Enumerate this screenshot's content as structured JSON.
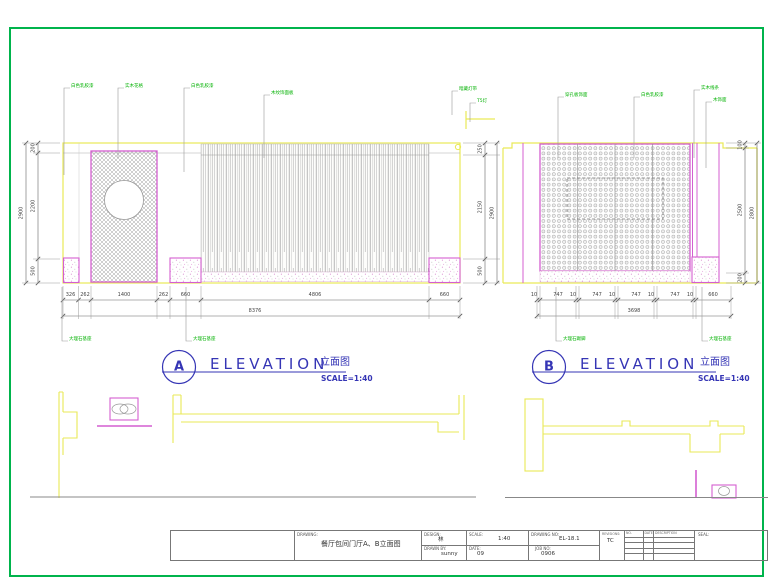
{
  "page": {
    "border_color": "#00b44c"
  },
  "titles": {
    "a": {
      "letter": "A",
      "word": "ELEVATION",
      "cn": "立面图",
      "scale": "SCALE=1:40"
    },
    "b": {
      "letter": "B",
      "word": "ELEVATION",
      "cn": "立面图",
      "scale": "SCALE=1:40"
    }
  },
  "dim_lines": [
    {
      "o": "h",
      "y": 300,
      "x1": 63,
      "x2": 460,
      "ticks": [
        63,
        78.5,
        91,
        157,
        170,
        201,
        429,
        460
      ],
      "labels": [
        {
          "t": "326",
          "x": 70.5
        },
        {
          "t": "262",
          "x": 85
        },
        {
          "t": "1400",
          "x": 124
        },
        {
          "t": "262",
          "x": 163.5
        },
        {
          "t": "660",
          "x": 185.5
        },
        {
          "t": "4806",
          "x": 315
        },
        {
          "t": "660",
          "x": 444.5
        }
      ]
    },
    {
      "o": "h",
      "y": 316,
      "x1": 63,
      "x2": 460,
      "ticks": [
        63,
        460
      ],
      "labels": [
        {
          "t": "8376",
          "x": 255
        }
      ]
    },
    {
      "o": "h",
      "y": 300,
      "x1": 537,
      "x2": 731,
      "ticks": [
        537,
        540,
        576,
        579,
        615,
        618,
        654,
        657,
        693,
        696,
        731
      ],
      "labels": [
        {
          "t": "10",
          "x": 534
        },
        {
          "t": "747",
          "x": 558
        },
        {
          "t": "10",
          "x": 573
        },
        {
          "t": "747",
          "x": 597
        },
        {
          "t": "10",
          "x": 612
        },
        {
          "t": "747",
          "x": 636
        },
        {
          "t": "10",
          "x": 651
        },
        {
          "t": "747",
          "x": 675
        },
        {
          "t": "10",
          "x": 690
        },
        {
          "t": "660",
          "x": 713
        }
      ]
    },
    {
      "o": "h",
      "y": 316,
      "x1": 537,
      "x2": 731,
      "ticks": [
        537,
        731
      ],
      "labels": [
        {
          "t": "3698",
          "x": 634
        }
      ]
    },
    {
      "o": "v",
      "x": 38,
      "y1": 143,
      "y2": 283,
      "ticks": [
        143,
        153,
        259,
        283
      ],
      "labels": [
        {
          "t": "200",
          "y": 148
        },
        {
          "t": "2200",
          "y": 206
        },
        {
          "t": "500",
          "y": 271
        }
      ]
    },
    {
      "o": "v",
      "x": 26,
      "y1": 143,
      "y2": 283,
      "ticks": [
        143,
        283
      ],
      "labels": [
        {
          "t": "2900",
          "y": 213
        }
      ]
    },
    {
      "o": "v",
      "x": 485,
      "y1": 143,
      "y2": 283,
      "ticks": [
        143,
        155,
        259,
        283
      ],
      "labels": [
        {
          "t": "250",
          "y": 149
        },
        {
          "t": "2150",
          "y": 207
        },
        {
          "t": "500",
          "y": 271
        }
      ]
    },
    {
      "o": "v",
      "x": 497,
      "y1": 143,
      "y2": 283,
      "ticks": [
        143,
        283
      ],
      "labels": [
        {
          "t": "2900",
          "y": 213
        }
      ]
    },
    {
      "o": "v",
      "x": 745,
      "y1": 143,
      "y2": 283,
      "ticks": [
        143,
        148,
        273,
        283
      ],
      "labels": [
        {
          "t": "100",
          "y": 144.5
        },
        {
          "t": "2500",
          "y": 210
        },
        {
          "t": "200",
          "y": 278
        }
      ]
    },
    {
      "o": "v",
      "x": 757,
      "y1": 143,
      "y2": 283,
      "ticks": [
        143,
        283
      ],
      "labels": [
        {
          "t": "2800",
          "y": 213
        }
      ]
    }
  ],
  "ext_lines": [
    {
      "o": "v",
      "xs": [
        63,
        78.5,
        91,
        157,
        170,
        201,
        429,
        460
      ],
      "y1": 286,
      "y2": 319
    },
    {
      "o": "v",
      "xs": [
        537,
        540,
        576,
        579,
        615,
        618,
        654,
        657,
        693,
        696,
        731
      ],
      "y1": 286,
      "y2": 319
    },
    {
      "o": "h",
      "ys": [
        143,
        283
      ],
      "x1": 22,
      "x2": 60
    },
    {
      "o": "h",
      "ys": [
        153,
        259
      ],
      "x1": 33,
      "x2": 60
    },
    {
      "o": "h",
      "ys": [
        143,
        155,
        259,
        283
      ],
      "x1": 463,
      "x2": 500
    },
    {
      "o": "h",
      "ys": [
        143,
        283
      ],
      "x1": 726,
      "x2": 761
    },
    {
      "o": "h",
      "ys": [
        148,
        273
      ],
      "x1": 726,
      "x2": 749
    }
  ],
  "annotations": [
    {
      "t": "白色乳胶漆",
      "x": 64,
      "y": 88,
      "d": 175
    },
    {
      "t": "实木花格",
      "x": 118,
      "y": 88,
      "d": 158
    },
    {
      "t": "白色乳胶漆",
      "x": 184,
      "y": 88,
      "d": 172
    },
    {
      "t": "木纹饰面板",
      "x": 264,
      "y": 95,
      "d": 158
    },
    {
      "t": "暗藏灯带",
      "x": 452,
      "y": 91,
      "d": 115
    },
    {
      "t": "T5灯",
      "x": 470,
      "y": 103,
      "d": 122
    },
    {
      "t": "大理石基座",
      "x": 62,
      "y": 341,
      "d": 287
    },
    {
      "t": "大理石基座",
      "x": 186,
      "y": 341,
      "d": 287
    },
    {
      "t": "穿孔板饰面",
      "x": 558,
      "y": 97,
      "d": 158
    },
    {
      "t": "白色乳胶漆",
      "x": 634,
      "y": 97,
      "d": 158
    },
    {
      "t": "实木线条",
      "x": 694,
      "y": 90,
      "d": 158
    },
    {
      "t": "木饰面",
      "x": 706,
      "y": 102,
      "d": 168
    },
    {
      "t": "大理石踢脚",
      "x": 556,
      "y": 341,
      "d": 287
    },
    {
      "t": "大理石基座",
      "x": 702,
      "y": 341,
      "d": 287
    }
  ],
  "title_block": {
    "drawing_label": "DRAWING:",
    "drawing_title": "餐厅包间门厅A、B立面图",
    "design_label": "DESIGN:",
    "design_value": "林",
    "drawn_by_label": "DRAWN BY:",
    "drawn_by_value": "sunny",
    "scale_label": "SCALE:",
    "scale_value": "1:40",
    "date_label": "DATE:",
    "date_value": "09",
    "drawing_no_label": "DRAWING NO:",
    "drawing_no_value": "EL-18.1",
    "job_no_label": "JOB NO:",
    "job_no_value": "0906",
    "revisions_label": "REVISIONS:",
    "revisions_value": "TC",
    "rev_col_no": "NO.",
    "rev_col_date": "DATE",
    "rev_col_desc": "DESCRIPTION",
    "seal_label": "SEAL:"
  }
}
